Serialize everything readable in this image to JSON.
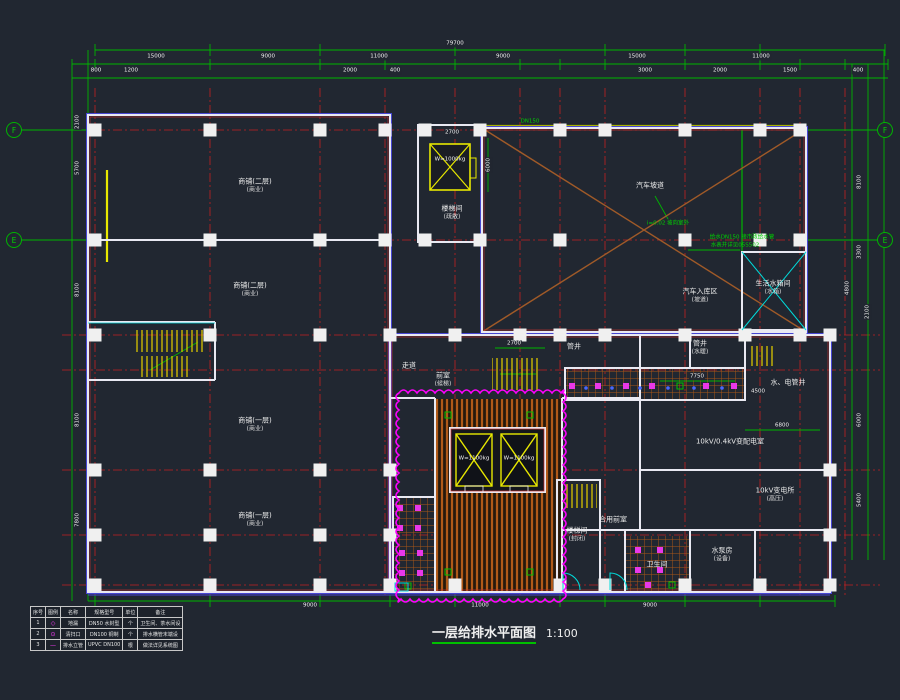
{
  "title": {
    "text": "一层给排水平面图",
    "scale": "1:100"
  },
  "colors": {
    "background": "#212731",
    "dimension_green": "#00b400",
    "grid_red": "#cc2222",
    "wall_white": "#e9e9f2",
    "hatch_orange": "#b05a19",
    "revision_magenta": "#ff00ff",
    "equipment_yellow": "#e8e800",
    "pipe_cyan": "#00dcdc"
  },
  "axes": {
    "bubbles": [
      {
        "t": "F",
        "x": 14,
        "y": 130
      },
      {
        "t": "E",
        "x": 14,
        "y": 240
      },
      {
        "t": "F",
        "x": 885,
        "y": 130
      },
      {
        "t": "E",
        "x": 885,
        "y": 240
      }
    ]
  },
  "labels": [
    {
      "cls": "dim",
      "t": "79700",
      "x": 455,
      "y": 44
    },
    {
      "cls": "dim",
      "t": "15000",
      "x": 156,
      "y": 57
    },
    {
      "cls": "dim",
      "t": "9000",
      "x": 268,
      "y": 57
    },
    {
      "cls": "dim",
      "t": "11000",
      "x": 379,
      "y": 57
    },
    {
      "cls": "dim",
      "t": "9000",
      "x": 503,
      "y": 57
    },
    {
      "cls": "dim",
      "t": "15000",
      "x": 637,
      "y": 57
    },
    {
      "cls": "dim",
      "t": "11000",
      "x": 761,
      "y": 57
    },
    {
      "cls": "dim",
      "t": "800",
      "x": 96,
      "y": 71
    },
    {
      "cls": "dim",
      "t": "1200",
      "x": 131,
      "y": 71
    },
    {
      "cls": "dim",
      "t": "2000",
      "x": 350,
      "y": 71
    },
    {
      "cls": "dim",
      "t": "400",
      "x": 395,
      "y": 71
    },
    {
      "cls": "dim",
      "t": "3000",
      "x": 645,
      "y": 71
    },
    {
      "cls": "dim",
      "t": "2000",
      "x": 720,
      "y": 71
    },
    {
      "cls": "dim",
      "t": "1500",
      "x": 790,
      "y": 71
    },
    {
      "cls": "dim",
      "t": "400",
      "x": 858,
      "y": 71
    },
    {
      "cls": "dim",
      "rot": 1,
      "t": "2100",
      "x": 78,
      "y": 122
    },
    {
      "cls": "dim",
      "rot": 1,
      "t": "5700",
      "x": 78,
      "y": 168
    },
    {
      "cls": "dim",
      "rot": 1,
      "t": "8100",
      "x": 78,
      "y": 290
    },
    {
      "cls": "dim",
      "rot": 1,
      "t": "8100",
      "x": 78,
      "y": 420
    },
    {
      "cls": "dim",
      "rot": 1,
      "t": "7800",
      "x": 78,
      "y": 520
    },
    {
      "cls": "dim",
      "rot": 1,
      "t": "8100",
      "x": 860,
      "y": 182
    },
    {
      "cls": "dim",
      "rot": 1,
      "t": "3300",
      "x": 860,
      "y": 252
    },
    {
      "cls": "dim",
      "rot": 1,
      "t": "4800",
      "x": 848,
      "y": 288
    },
    {
      "cls": "dim",
      "rot": 1,
      "t": "2100",
      "x": 868,
      "y": 312
    },
    {
      "cls": "dim",
      "rot": 1,
      "t": "6000",
      "x": 860,
      "y": 420
    },
    {
      "cls": "dim",
      "rot": 1,
      "t": "5400",
      "x": 860,
      "y": 500
    },
    {
      "cls": "dim",
      "t": "9000",
      "x": 310,
      "y": 606
    },
    {
      "cls": "dim",
      "t": "11000",
      "x": 480,
      "y": 606
    },
    {
      "cls": "dim",
      "t": "9000",
      "x": 650,
      "y": 606
    },
    {
      "cls": "dim",
      "t": "2700",
      "x": 452,
      "y": 133
    },
    {
      "cls": "dim",
      "rot": 1,
      "t": "6000",
      "x": 489,
      "y": 165
    },
    {
      "cls": "dim",
      "t": "2700",
      "x": 514,
      "y": 344
    },
    {
      "cls": "dim",
      "t": "7750",
      "x": 697,
      "y": 377
    },
    {
      "cls": "dim",
      "t": "4500",
      "x": 758,
      "y": 392
    },
    {
      "cls": "dim",
      "t": "6800",
      "x": 782,
      "y": 426
    },
    {
      "cls": "room",
      "t": "商铺(二层)",
      "sub": "(商业)",
      "x": 255,
      "y": 186
    },
    {
      "cls": "room",
      "t": "商铺(二层)",
      "sub": "(商业)",
      "x": 250,
      "y": 290
    },
    {
      "cls": "room",
      "t": "商铺(一层)",
      "sub": "(商业)",
      "x": 255,
      "y": 425
    },
    {
      "cls": "room",
      "t": "商铺(一层)",
      "sub": "(商业)",
      "x": 255,
      "y": 520
    },
    {
      "cls": "room",
      "t": "楼梯间",
      "sub": "(疏散)",
      "x": 452,
      "y": 213
    },
    {
      "cls": "room",
      "t": "汽车坡道",
      "x": 650,
      "y": 186
    },
    {
      "cls": "room",
      "t": "汽车入库区",
      "sub": "(坡道)",
      "x": 700,
      "y": 296
    },
    {
      "cls": "room",
      "t": "生活水箱间",
      "sub": "(水箱)",
      "x": 773,
      "y": 288
    },
    {
      "cls": "room",
      "t": "走道",
      "x": 409,
      "y": 366
    },
    {
      "cls": "room",
      "t": "前室",
      "sub": "(候梯)",
      "x": 443,
      "y": 380
    },
    {
      "cls": "room",
      "t": "管井",
      "x": 574,
      "y": 347
    },
    {
      "cls": "room",
      "t": "管井",
      "sub": "(水暖)",
      "x": 700,
      "y": 348
    },
    {
      "cls": "room",
      "t": "水、电管井",
      "x": 788,
      "y": 383
    },
    {
      "cls": "room",
      "t": "10kV/0.4kV变配电室",
      "x": 730,
      "y": 442
    },
    {
      "cls": "room",
      "t": "10kV变电所",
      "sub": "(高压)",
      "x": 775,
      "y": 495
    },
    {
      "cls": "room",
      "t": "楼梯间",
      "sub": "(封闭)",
      "x": 577,
      "y": 535
    },
    {
      "cls": "room",
      "t": "合用前室",
      "x": 613,
      "y": 520
    },
    {
      "cls": "room",
      "t": "水泵房",
      "sub": "(设备)",
      "x": 722,
      "y": 555
    },
    {
      "cls": "room",
      "t": "卫生间",
      "x": 657,
      "y": 565
    },
    {
      "cls": "note",
      "t": "给水DN150 接市政给水管",
      "x": 742,
      "y": 238
    },
    {
      "cls": "note",
      "t": "水表井详见05S502",
      "x": 735,
      "y": 246
    },
    {
      "cls": "note",
      "t": "i=0.02 坡向室外",
      "x": 668,
      "y": 224
    },
    {
      "cls": "note",
      "t": "DN150",
      "x": 530,
      "y": 122
    },
    {
      "cls": "elev",
      "t": "W=1000kg",
      "x": 450,
      "y": 160
    },
    {
      "cls": "elev",
      "t": "W=1100kg",
      "x": 474,
      "y": 459
    },
    {
      "cls": "elev",
      "t": "W=1100kg",
      "x": 519,
      "y": 459
    }
  ],
  "legend_table": {
    "headers": [
      "序号",
      "图例",
      "名称",
      "规格型号",
      "单位",
      "备注"
    ],
    "rows": [
      [
        "1",
        "◇",
        "地漏",
        "DN50 水封型",
        "个",
        "卫生间、茶水间设"
      ],
      [
        "2",
        "⊙",
        "清扫口",
        "DN100 铜制",
        "个",
        "排水横管末端设"
      ],
      [
        "3",
        "—",
        "排水立管",
        "UPVC DN100",
        "根",
        "做法详见系统图"
      ]
    ]
  }
}
